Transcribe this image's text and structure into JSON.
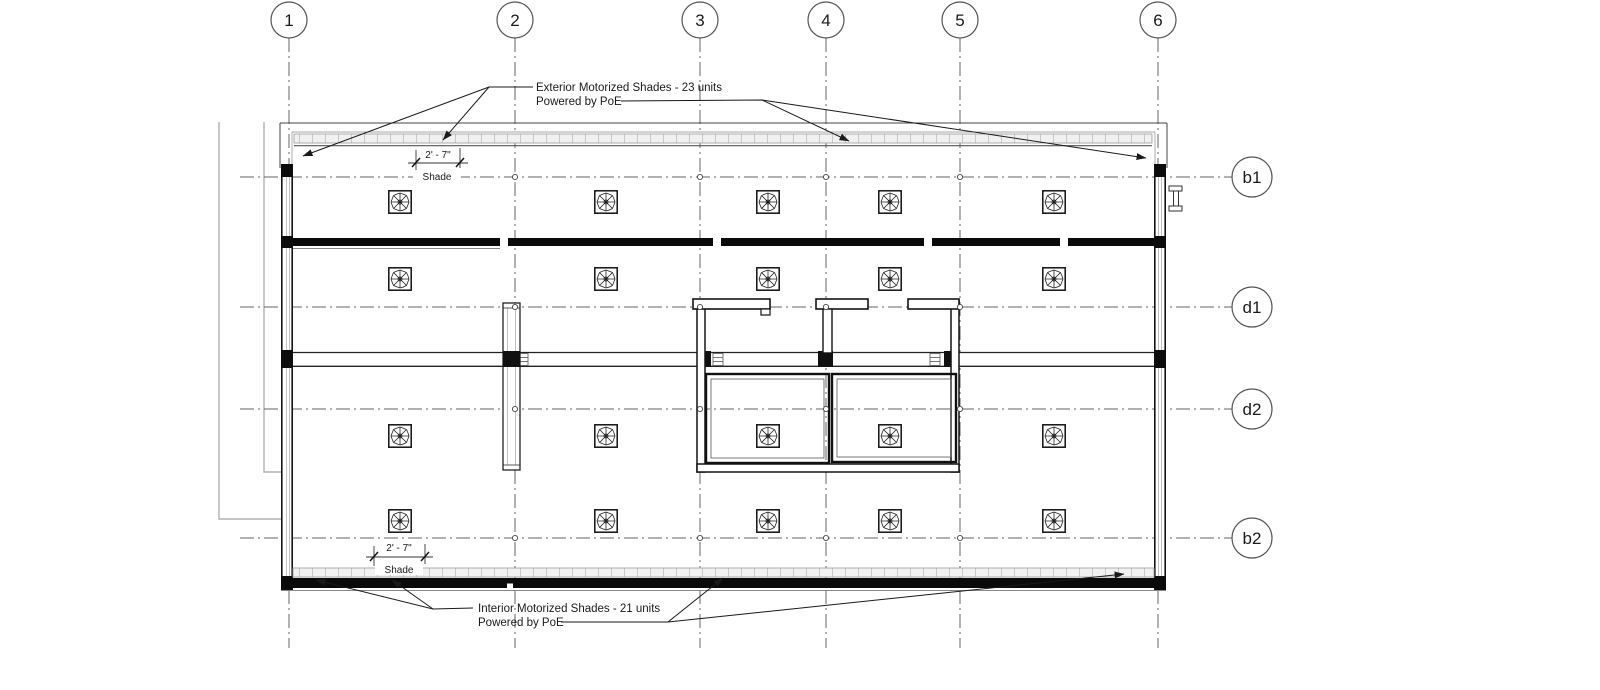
{
  "drawing": {
    "type": "architectural-floor-plan",
    "grid": {
      "column_bubbles": [
        "1",
        "2",
        "3",
        "4",
        "5",
        "6"
      ],
      "row_bubbles": [
        "b1",
        "d1",
        "d2",
        "b2"
      ]
    },
    "annotations": {
      "exterior_shades": {
        "line1": "Exterior  Motorized Shades - 23 units",
        "line2": "Powered by PoE"
      },
      "interior_shades": {
        "line1": "Interior Motorized Shades - 21 units",
        "line2": "Powered by PoE"
      }
    },
    "dimensions": {
      "top_shade": {
        "value": "2' - 7\"",
        "label": "Shade"
      },
      "bottom_shade": {
        "value": "2' - 7\"",
        "label": "Shade"
      }
    },
    "colors": {
      "line": "#141414",
      "grid_line": "#666666",
      "reference_gray": "#b0b0b0",
      "shade_band_fill": "#f1f1f1",
      "shade_band_tick": "#c8c8c8"
    }
  }
}
